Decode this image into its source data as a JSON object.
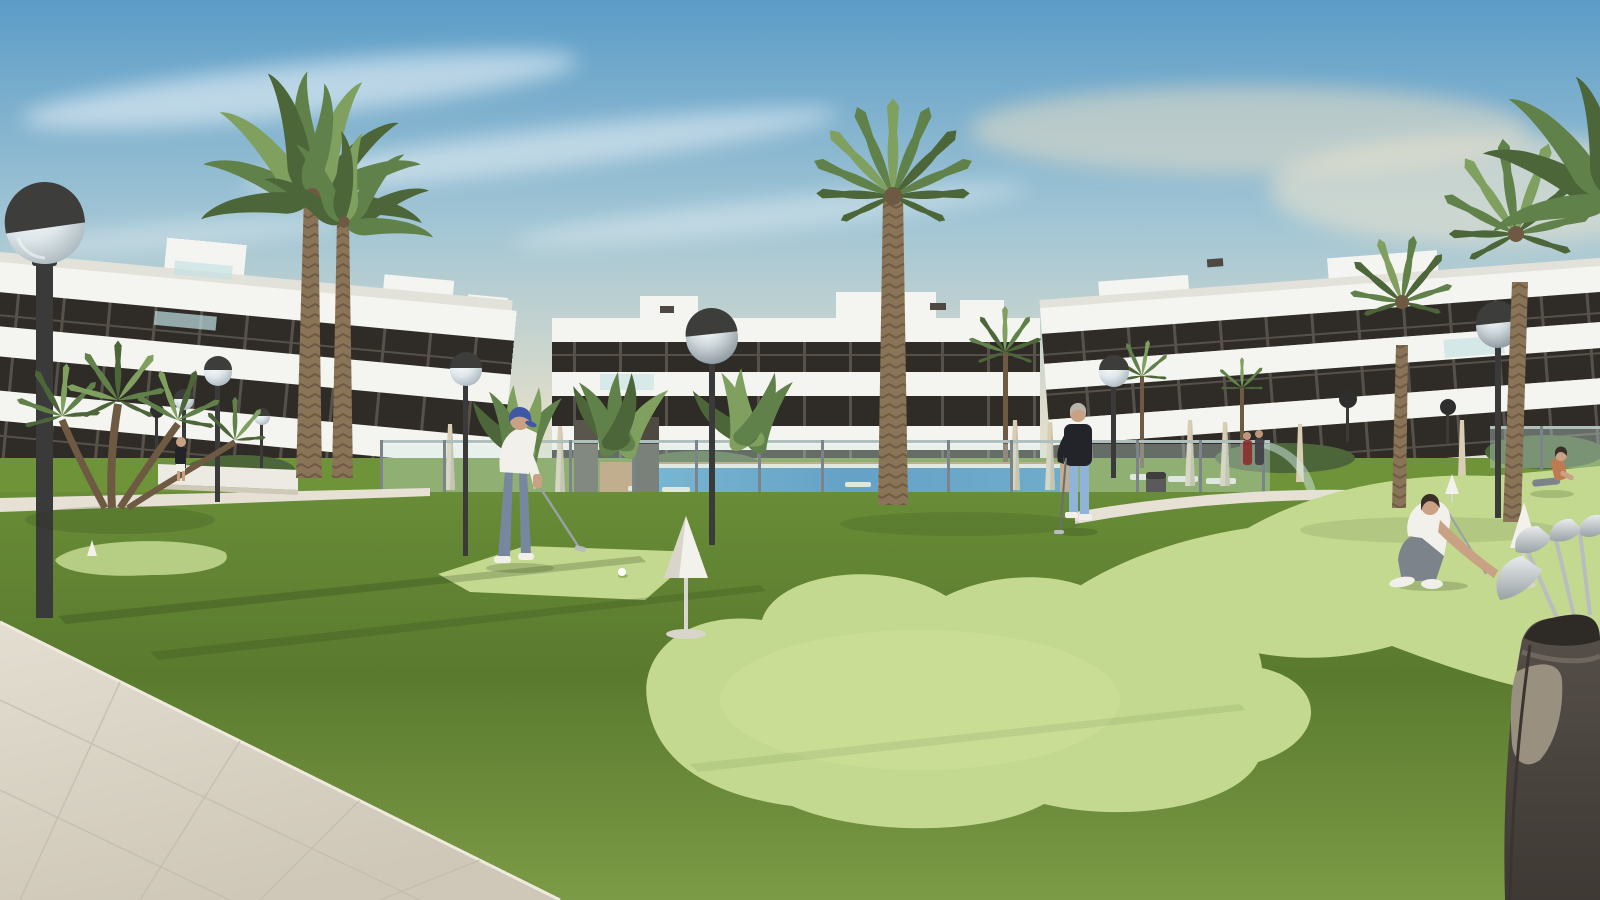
{
  "meta": {
    "width": 1600,
    "height": 900,
    "kind": "architectural exterior render, no UI text visible"
  },
  "scene": {
    "description": "Sunlit 3D render of a modern white three-storey apartment complex surrounding a communal pool and a light-green clover-shaped artificial putting green on darker lawn, with palm trees, globe street lamps and residents playing golf.",
    "sky": {
      "condition": "blue sky with wispy cirrus clouds, warm cream haze near the horizon on the right"
    },
    "buildings": [
      {
        "id": "left",
        "storeys": 3,
        "style": "white horizontal fascia bands with dark recessed glazing, rooftop penthouse boxes, teal glass balustrades"
      },
      {
        "id": "center",
        "storeys": 3,
        "style": "white bands, dark window strips, rooftop boxes and small AC units"
      },
      {
        "id": "right",
        "storeys": 3,
        "style": "white bands rising toward the right edge, dark glazing"
      }
    ],
    "pool_area": {
      "pool": "blue lap pool with white coping",
      "deck": "terracotta paving",
      "fence": "transparent glass pool fence with slim grey posts and rounded corner",
      "furniture": [
        "white sun loungers",
        "closed beige parasols",
        "grey litter bin",
        "two dark glass pillar monoliths"
      ]
    },
    "putting_green": {
      "shapes": [
        "small island green far left with mini cone",
        "diamond tee pad under the putting golfer",
        "large clover-shaped green center",
        "sweeping green band to the right edge"
      ],
      "markers": [
        "tall white cone marker on center green",
        "white cone marker beside crouching player",
        "tiny cone in right background"
      ],
      "balls": 2
    },
    "paths": {
      "foreground": "large beige stone-tile walkway lower left",
      "mid": "light curved walkway in front of the pool fence"
    },
    "vegetation": [
      "two tall date palms left",
      "tall fan palm center",
      "two fan palms right plus corner fronds",
      "multi-trunk fan palm bush far left",
      "banana plants by the pool",
      "small background palms and hedges"
    ],
    "lighting": {
      "street_lamps": 11,
      "style": "black poles with spherical glass globes, dark caps; large lamp in left foreground; long lamp shadows across the lawn"
    },
    "people": [
      {
        "id": "putting-golfer",
        "pose": "bent over a putt",
        "clothes": "white polo, blue cap, grey-blue trousers, white shoes"
      },
      {
        "id": "standing-golfer",
        "pose": "standing watching, holding putter",
        "clothes": "black sweater, light blue jeans, white shoes, grey hair"
      },
      {
        "id": "crouching-golfer",
        "pose": "crouched placing a ball by a cone",
        "clothes": "white polo, grey trousers, white sneakers, dark hair"
      },
      {
        "id": "seated-woman",
        "pose": "sitting on the grass far right",
        "clothes": "orange-tan top"
      },
      {
        "id": "couple-at-fence",
        "pose": "two small figures by the pool fence"
      },
      {
        "id": "walking-person",
        "pose": "small figure near the left building",
        "clothes": "dark top, white shorts"
      }
    ],
    "equipment": {
      "golf_bag": "dark charcoal golf bag with tan pocket and silver iron heads, bottom right corner"
    }
  },
  "colors": {
    "skyTop": "#5b9cc7",
    "skyMid": "#a3c6d5",
    "skyHorizon": "#ece6d3",
    "buildingWhite": "#f4f4f0",
    "buildingWhiteShade": "#e3e2da",
    "glazing": "#2f2b26",
    "glazingLight": "#4a443c",
    "glassTeal": "#bfe0e2",
    "grassBack": "#6f9338",
    "grassDark": "#5d7e31",
    "greenLight": "#c3d98f",
    "greenLightHi": "#cfe19c",
    "greenShade": "#b6cd84",
    "pathTile": "#d9d3c5",
    "pathLight": "#e6e1d4",
    "deckTerracotta": "#bb8f63",
    "poolWater": "#2e7cb7",
    "glassFence": "#cfe7e3",
    "fencePost": "#7c8489",
    "palmTrunk": "#8a7458",
    "palmTrunkDark": "#6e5a42",
    "frondDark": "#4c6639",
    "frondMid": "#61814a",
    "frondLight": "#7fa05e",
    "lampPole": "#3a3a3a",
    "lampGlobeDark": "#2e2e2e",
    "umbrella": "#d9cdb4",
    "umbrellaShade": "#bfb298",
    "lounger": "#e8e6de",
    "binGray": "#5a5a58",
    "skin": "#c9a185",
    "capBlue": "#3f57a5",
    "shirtWhite": "#f2f0ea",
    "pantsBlueGray": "#7787a0",
    "sweaterDark": "#23232a",
    "jeans": "#8fb3d9",
    "hairGray": "#b9b4ac",
    "hairDark": "#3a2f28",
    "pantsGray": "#7d838b",
    "shoeWhite": "#f0efe9",
    "bagBody": "#4b4540",
    "bagPocket": "#99907f",
    "clubSilver": "#c6c9cb",
    "coneWhite": "#f2f1ec",
    "coneShade": "#d9d5ca",
    "wallWhite": "#eceae2"
  }
}
